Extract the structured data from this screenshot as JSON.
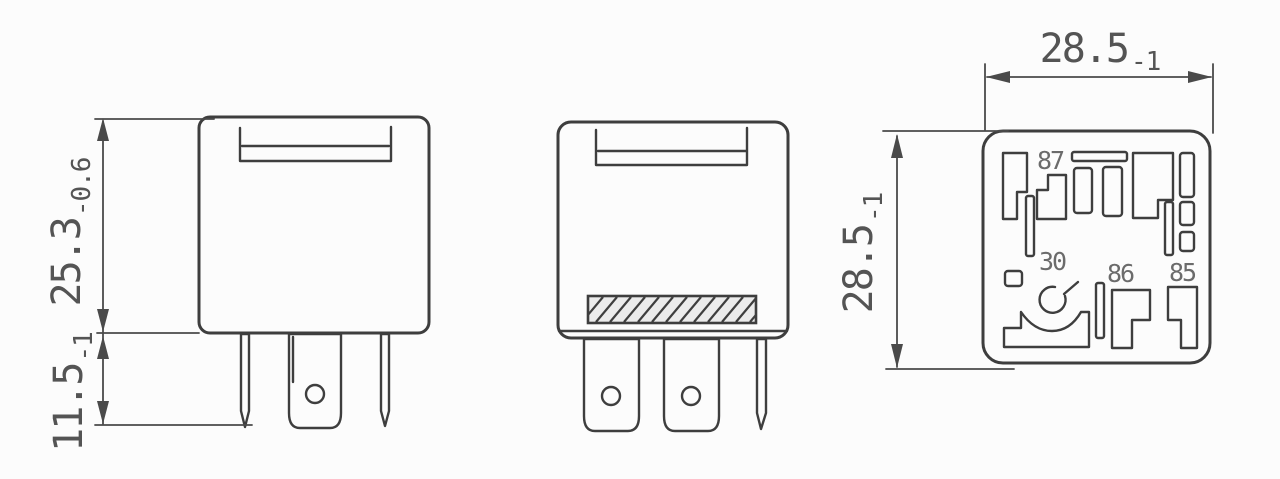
{
  "colors": {
    "line": "#3e3e3e",
    "dim": "#4a4a4a",
    "text": "#545454",
    "label": "#6b6b6b",
    "bg": "#fcfcfc",
    "hatch_fill": "#ebebeb"
  },
  "dims": {
    "body_height": {
      "value": "25.3",
      "tol": "-0.6"
    },
    "pin_length": {
      "value": "11.5",
      "tol": "-1"
    },
    "base_width": {
      "value": "28.5",
      "tol": "-1"
    },
    "base_depth": {
      "value": "28.5",
      "tol": "-1"
    }
  },
  "terminals": {
    "t87": "87",
    "t30": "30",
    "t86": "86",
    "t85": "85"
  }
}
